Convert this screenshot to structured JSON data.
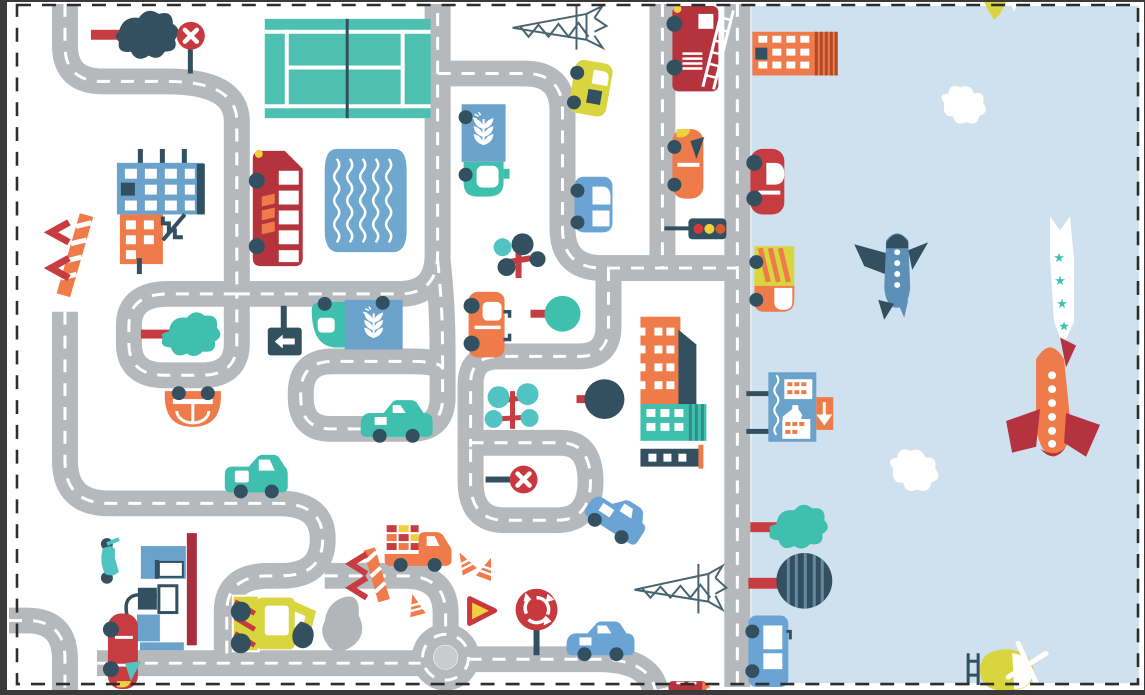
{
  "illustration": {
    "kind": "city-road-play-mat",
    "regions": {
      "ground": "white town area with winding roads",
      "right_strip": "light blue sky / airfield"
    }
  },
  "palette": {
    "frame": "#3a3a3a",
    "border": "#2d2d2d",
    "white": "#ffffff",
    "road": "#b6b9bb",
    "roadDash": "#ffffff",
    "island": "#c9ccce",
    "sky": "#cfe1ee",
    "navy": "#32505f",
    "slate": "#49646f",
    "teal": "#3fbfae",
    "tealLight": "#52c3c3",
    "court": "#4ec0b2",
    "crimson": "#b5333c",
    "red": "#c63c40",
    "signRed": "#c8383f",
    "wingRed": "#b5333f",
    "orange": "#ee7b49",
    "orangeDeep": "#d95f33",
    "stripeBrown": "#b04a28",
    "yellow": "#f0d03c",
    "yellowGreen": "#d8d53e",
    "blue": "#6aa2cb",
    "blueCar": "#6aa4d4",
    "steelBlue": "#5d90b6",
    "poolBlue": "#6fa7cf",
    "gasRed": "#a8303a",
    "rockGray": "#b3b6b8"
  },
  "objects": [
    {
      "name": "dashed-selection-border"
    },
    {
      "name": "sky-strip"
    },
    {
      "name": "road-network"
    },
    {
      "name": "roundabout"
    },
    {
      "name": "tennis-court"
    },
    {
      "name": "swimming-pool"
    },
    {
      "name": "apartment-building-blue-orange"
    },
    {
      "name": "orange-building-striped"
    },
    {
      "name": "orange-building-mid"
    },
    {
      "name": "teal-building"
    },
    {
      "name": "navy-low-building"
    },
    {
      "name": "school-building-with-arrow-sign"
    },
    {
      "name": "gas-station"
    },
    {
      "name": "double-decker-bus"
    },
    {
      "name": "fire-truck"
    },
    {
      "name": "bakery-truck-wheat"
    },
    {
      "name": "cargo-truck-wheat"
    },
    {
      "name": "yellow-truck"
    },
    {
      "name": "crate-truck"
    },
    {
      "name": "excavator"
    },
    {
      "name": "taxi-orange"
    },
    {
      "name": "orange-car-front"
    },
    {
      "name": "orange-car-side"
    },
    {
      "name": "red-car-top"
    },
    {
      "name": "red-car-gas"
    },
    {
      "name": "red-car-bottom-edge"
    },
    {
      "name": "blue-van"
    },
    {
      "name": "blue-car-tilted"
    },
    {
      "name": "blue-sedan"
    },
    {
      "name": "blue-car-right"
    },
    {
      "name": "blue-bus-right"
    },
    {
      "name": "teal-minivan"
    },
    {
      "name": "teal-sedan"
    },
    {
      "name": "yellow-green-van"
    },
    {
      "name": "scooter"
    },
    {
      "name": "airplane-steel-blue"
    },
    {
      "name": "airplane-orange"
    },
    {
      "name": "glider-partial"
    },
    {
      "name": "helicopter"
    },
    {
      "name": "star-banner"
    },
    {
      "name": "cloud"
    },
    {
      "name": "cloud"
    },
    {
      "name": "tree-navy-blob"
    },
    {
      "name": "tree-teal-blob"
    },
    {
      "name": "tree-teal-blob-right"
    },
    {
      "name": "tree-navy-striped"
    },
    {
      "name": "tree-teal-round"
    },
    {
      "name": "tree-navy-round"
    },
    {
      "name": "berry-tree-cluster"
    },
    {
      "name": "lollipop-trees"
    },
    {
      "name": "stop-sign-x"
    },
    {
      "name": "stop-sign-x-2"
    },
    {
      "name": "roundabout-sign"
    },
    {
      "name": "yield-sign"
    },
    {
      "name": "left-arrow-sign"
    },
    {
      "name": "traffic-light"
    },
    {
      "name": "traffic-cones"
    },
    {
      "name": "crossing-barrier-left"
    },
    {
      "name": "crossing-barrier-right"
    },
    {
      "name": "power-pylon-top"
    },
    {
      "name": "power-pylon-bottom"
    },
    {
      "name": "rock"
    }
  ],
  "traffic_light_colors": [
    "#d23c35",
    "#f0d03c",
    "#d25b35"
  ],
  "star_glyph": "★"
}
